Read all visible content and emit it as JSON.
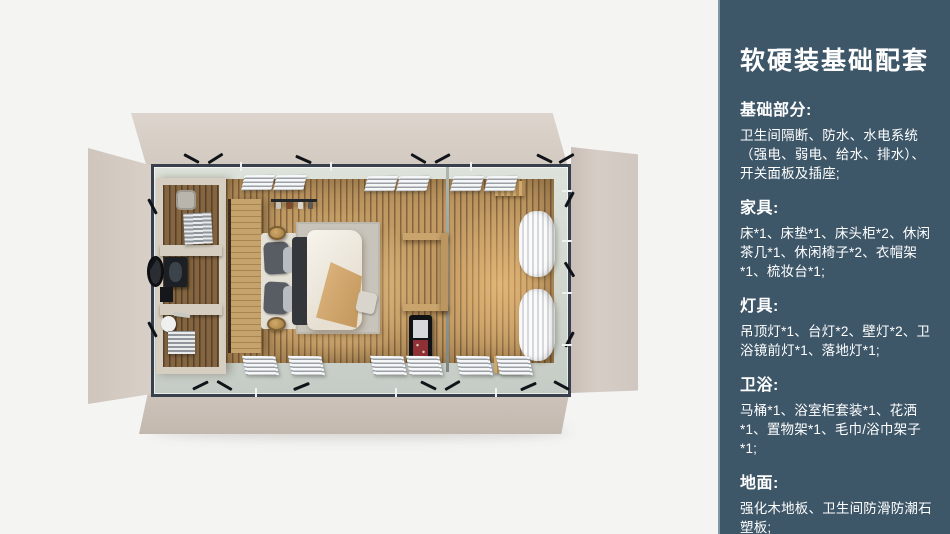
{
  "colors": {
    "canvas_bg": "#f4f4f3",
    "sidebar_bg": "#3d5668",
    "sidebar_text": "#ffffff",
    "cabin_panel": "#d5ccc4",
    "steel_frame": "#39404d",
    "wood_floor_light": "#c19a63",
    "wood_floor_dark": "#84653f",
    "lamp_glow": "#f0c083",
    "walkway_glass": "#ccd3cd",
    "duvet": "#f2efe8",
    "blanket": "#d0a76b"
  },
  "render": {
    "type": "top-down-room-render",
    "elements": [
      "bathroom",
      "bed",
      "headboard-wall",
      "coat-rack",
      "wall-shelves",
      "minibar-cabinet",
      "curtains",
      "window-blinds"
    ]
  },
  "sidebar": {
    "title": "软硬装基础配套",
    "sections": [
      {
        "heading": "基础部分:",
        "body": "卫生间隔断、防水、水电系统（强电、弱电、给水、排水）、开关面板及插座;"
      },
      {
        "heading": "家具:",
        "body": "床*1、床垫*1、床头柜*2、休闲茶几*1、休闲椅子*2、衣帽架*1、梳妆台*1;"
      },
      {
        "heading": "灯具:",
        "body": "吊顶灯*1、台灯*2、壁灯*2、卫浴镜前灯*1、落地灯*1;"
      },
      {
        "heading": "卫浴:",
        "body": "马桶*1、浴室柜套装*1、花洒*1、置物架*1、毛巾/浴巾架子*1;"
      },
      {
        "heading": "地面:",
        "body": "强化木地板、卫生间防滑防潮石塑板;"
      }
    ]
  }
}
